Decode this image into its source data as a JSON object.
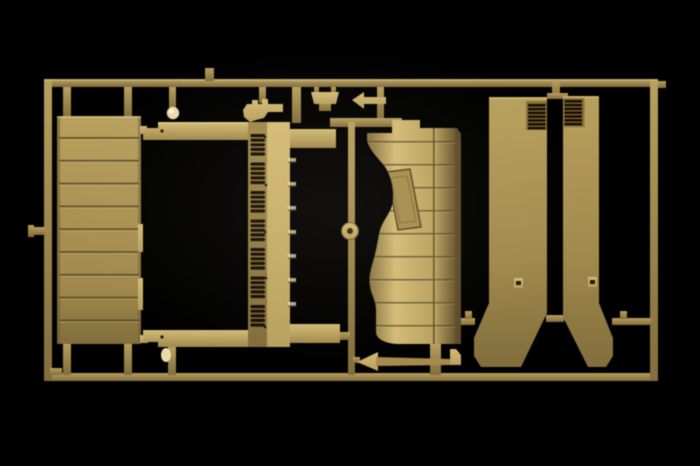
{
  "image": {
    "kind": "photograph",
    "subject": "Injection-molded model kit sprue (parts tree) of tan plastic on a black background",
    "width_px": 700,
    "height_px": 466
  },
  "palette": {
    "background": "#020202",
    "plastic_light": "#d3ba74",
    "plastic_base": "#b89f5c",
    "plastic_mid": "#a1894b",
    "plastic_dark": "#836e3c",
    "plastic_deep": "#554424",
    "groove": "#584826",
    "recess": "#181004",
    "highlight": "#ecdca6",
    "knob_bright": "#e8d9a8"
  },
  "sprue": {
    "frame": {
      "left": 44,
      "top": 79,
      "right": 658,
      "bottom": 381,
      "rail_thickness": 8
    },
    "parts": [
      {
        "id": "ribbed-panel",
        "label": "ribbed cargo side panel",
        "rib_segments": 10
      },
      {
        "id": "bed-frame",
        "label": "H-shaped bed frame with louvered spine",
        "slot_groups": [
          5,
          5,
          5,
          5,
          5,
          5,
          5
        ],
        "spine_ticks": 7
      },
      {
        "id": "curved-panel",
        "label": "fender panel with wheel-arch cutout and slanted hatch",
        "rib_lines": 9
      },
      {
        "id": "vent-panel-left",
        "label": "vertical panel with vent louvers and flared foot",
        "louver_slats": 7
      },
      {
        "id": "vent-panel-right",
        "label": "mirrored vertical panel with vent louvers and flared foot",
        "louver_slats": 7
      },
      {
        "id": "pioneer-tool",
        "label": "long axe / pry tool"
      },
      {
        "id": "filler-cap",
        "label": "small round cap with center hole"
      },
      {
        "id": "mg-bracket",
        "label": "small notched bracket"
      },
      {
        "id": "clamp-bracket",
        "label": "small trapezoid bracket with tab"
      },
      {
        "id": "hatchet-head",
        "label": "small arrow-shaped blade"
      },
      {
        "id": "round-knob",
        "label": "small ball knob"
      }
    ]
  }
}
